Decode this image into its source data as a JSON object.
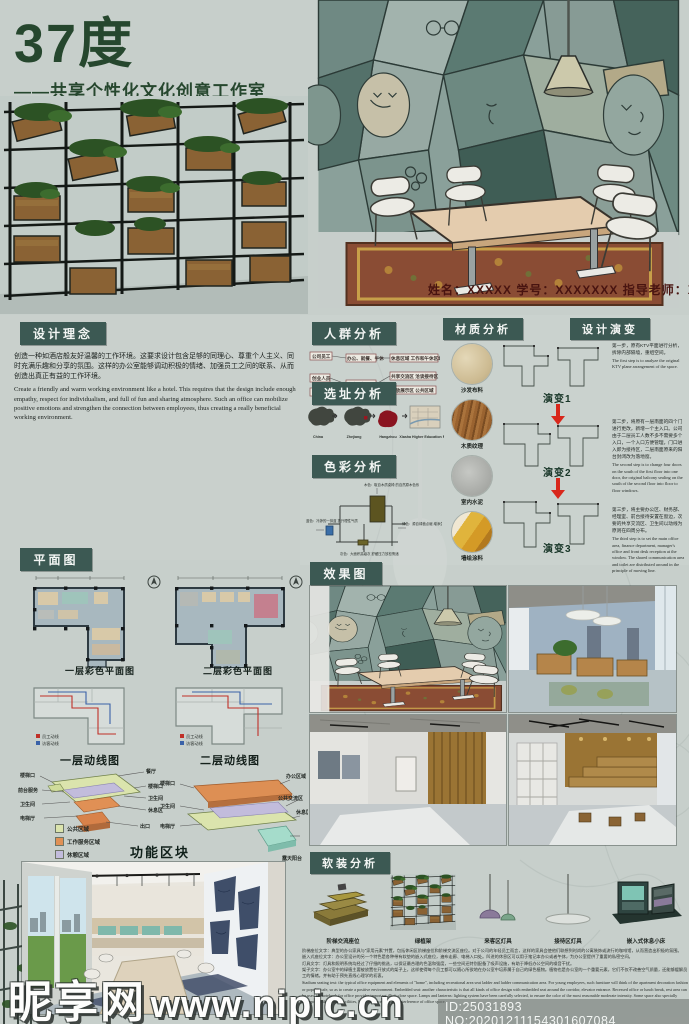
{
  "header": {
    "title": "37度",
    "subtitle": "——共享个性化文化创意工作室",
    "credits": "姓名：XXXXX  学号：XXXXXXX      指导老师：XXX"
  },
  "design_concept": {
    "label": "设计理念",
    "zh": "创造一种如酒店般友好温馨的工作环境。这要求设计包含足够的同理心、尊重个人主义、同时充满乐趣和分享的氛围。这样的办公室能够调动积极的情绪、加强员工之间的联系、从而创造出真正有益的工作环境。",
    "en": "Create a friendly and warm working environment like a hotel. This requires that the design include enough empathy, respect for individualism, and full of fun and sharing atmosphere. Such an office can mobilize positive emotions and strengthen the connection between employees, thus creating a really beneficial working environment."
  },
  "crowd": {
    "label": "人群分析",
    "left": [
      "公司员工",
      "创业人员",
      "外来人员"
    ],
    "mid": [
      "办公、就餐、午休",
      "洽谈、参观、交流"
    ],
    "right": [
      "休息区域 工作和午休区域",
      "共享交流区 洽谈接待区",
      "开放展示区 公共区域"
    ]
  },
  "site": {
    "label": "选址分析",
    "steps": [
      "China",
      "Zhejiang",
      "Hangzhou",
      "Xiasha Higher Education Park"
    ]
  },
  "color_analysis": {
    "label": "色彩分析",
    "notes": [
      "木色：取自木质桌椅 的自然原木色系",
      "绿色：源自绿植点缀 增添生机活力",
      "蓝色：冷静的一抹蓝 提升理性气质",
      "灰色：大面积高级灰 舒缓压力放松情绪"
    ]
  },
  "materials": {
    "label": "材质分析",
    "items": [
      {
        "name": "沙发布料"
      },
      {
        "name": "木质纹理"
      },
      {
        "name": "室内水泥"
      },
      {
        "name": "墙绘涂料"
      }
    ]
  },
  "evolution": {
    "label": "设计演变",
    "tags": [
      "演变1",
      "演变2",
      "演变3"
    ],
    "steps": [
      {
        "zh": "第一步，原有KTV平面进行分析，拆除内部隔墙，重组空间。",
        "en": "The first step is to analyze the original KTV plane arrangement of the space."
      },
      {
        "zh": "第二步，将原有一层南面的四个门进行更改，新增一个主入口。公司由于二层员工人数不多不需要多个入口，一个入口方便管理，门口进入即为接待区，二层南面原来的阳台封闭改为落地窗。",
        "en": "The second step is to change four doors on the south of the first floor into one door, the original balcony sealing on the south of the second floor into floor to floor windows."
      },
      {
        "zh": "第三步，将主要办公区、财务部、经理室、前台接待安置在窗边，次要的共享交流区、卫生间以动线为原则在四周分布。",
        "en": "The third step is to set the main office area, finance department, manager's office and front desk reception at the window. The shared communication area and toilet are distributed around in the principle of moving line."
      }
    ]
  },
  "floor_plan": {
    "label": "平面图",
    "captions": [
      "一层彩色平面图",
      "二层彩色平面图",
      "一层动线图",
      "二层动线图"
    ],
    "legend": [
      "员工动线",
      "访客动线"
    ]
  },
  "function_blocks": {
    "label": "功能区块",
    "legend": [
      "公共区域",
      "工作服务区域",
      "休憩区域"
    ],
    "left_diagram": {
      "left_labels": [
        "楼梯口",
        "前台服务",
        "卫生间",
        "电梯厅"
      ],
      "right_labels": [
        "餐厅",
        "楼梯口",
        "卫生间",
        "休息区",
        "出口"
      ]
    },
    "right_diagram": {
      "left_labels": [
        "楼梯口",
        "卫生间",
        "电梯厅"
      ],
      "right_labels": [
        "办公区域",
        "公共交流区",
        "休息区",
        "露天阳台"
      ]
    }
  },
  "renderings": {
    "label": "效果图"
  },
  "soft": {
    "label": "软装分析",
    "items": [
      "阶梯交流座位",
      "绿植架",
      "来客区灯具",
      "接待区灯具",
      "嵌入式休息小床"
    ],
    "desc_zh_1": "阶梯座位文字：典型的办公家具与“家用元素”并置，包括休闲区阶梯座位和阶梯交流区座位。对于公司的年轻员工而言，这样的家具会使他们联想到时尚的公寓装饰或流行的咖啡馆，从而营造出积极的氛围。",
    "desc_zh_2": "嵌入式座位文字：办公室设计的另一个特色是各种带有软垫的嵌入式座位，遍布走廊、电梯入口处。凹进的休息区可以用于笔记本办公或者午休，为办公室提供了重要的私密空间。",
    "desc_zh_3": "灯具文字：灯具和照明系统均经过了仔细的挑选，以保证最合理的色温和强度，一些空间还特别配备了吸声设施，有助于降低办公空间的噪音干扰。",
    "desc_zh_4": "架子文字：办公室中的绿植主要被放置在开放式的架子上，这样使得每个员工都可以随心所欲地在办公室中培养属于自己的绿色植物。植物也是办公室的一个重要元素，它们不仅不改善空气质量，还能够缓解员工的情绪。并有助于预先直线心理学的初衷。",
    "desc_en": "Stadium seating text: the typical office equipment and elements of \"home\", including recreational area seat ladder and ladder communication area. For young employees, such furniture will think of the apartment decoration fashion or popular cafe, so as to create a positive environment. Embedded seat: another characteristic is that all kinds of office design with embedded seat around the corridor, elevator entrance. Recessed office or lunch break, rest area can be used for notebook for office provides important illicit close space. Lamps and lanterns: lighting system have been carefully selected, to ensure the color of the most reasonable moderate intensity. Some space also specially equipped with acoustic facilities, help to reduce the noise interference of office space."
  },
  "watermark": {
    "site": "昵享网",
    "url": "www.nipic.cn",
    "id_line": "ID:25031893 NO:20201211154301607084"
  },
  "colors": {
    "accent": "#3c5953",
    "title_green": "#26472e",
    "arrow_red": "#d8271b"
  }
}
